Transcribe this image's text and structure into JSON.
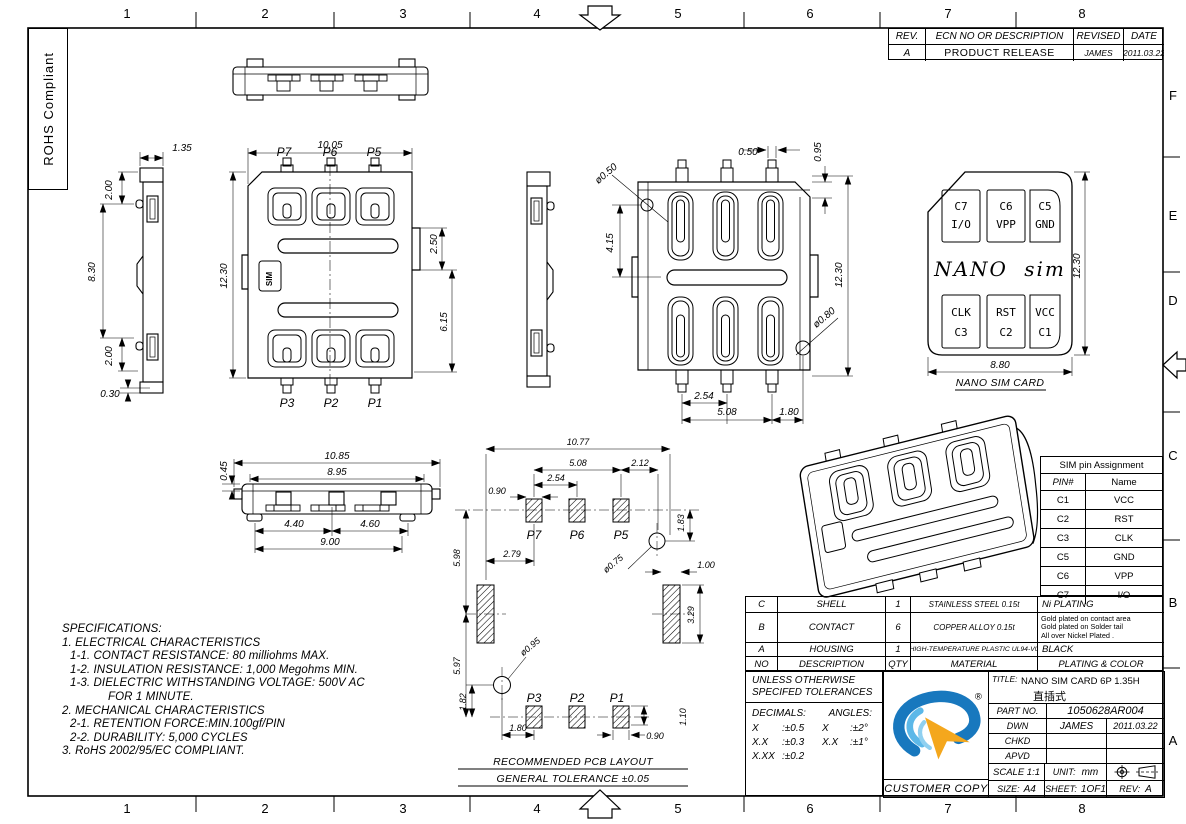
{
  "sheet": {
    "rohs": "ROHS Compliant",
    "zones_top": [
      "1",
      "2",
      "3",
      "4",
      "5",
      "6",
      "7",
      "8"
    ],
    "zones_bottom": [
      "1",
      "2",
      "3",
      "4",
      "5",
      "6",
      "7",
      "8"
    ],
    "zone_letters": [
      "F",
      "E",
      "D",
      "C",
      "B",
      "A"
    ]
  },
  "revision_table": {
    "rev_h": "REV.",
    "desc_h": "ECN NO OR DESCRIPTION",
    "revised_h": "REVISED",
    "date_h": "DATE",
    "rows": [
      {
        "rev": "A",
        "desc": "PRODUCT RELEASE",
        "revised": "JAMES",
        "date": "2011.03.22"
      }
    ]
  },
  "views": {
    "side_left": {
      "d_135": "1.35",
      "d_200_top": "2.00",
      "d_830": "8.30",
      "d_200_bot": "2.00",
      "d_030": "0.30"
    },
    "top_view": {
      "d_1005": "10.05",
      "d_1230": "12.30",
      "d_250": "2.50",
      "d_615": "6.15",
      "sim": "SIM",
      "p7": "P7",
      "p6": "P6",
      "p5": "P5",
      "p3": "P3",
      "p2": "P2",
      "p1": "P1"
    },
    "back_view": {
      "dia_050": "ø0.50",
      "d_050": "0.50",
      "d_095": "0.95",
      "d_415": "4.15",
      "d_1230": "12.30",
      "dia_080": "ø0.80",
      "d_254": "2.54",
      "d_508": "5.08",
      "d_180": "1.80"
    },
    "nano_card": {
      "brand": "NANO sim",
      "caption": "NANO SIM CARD",
      "d_1230": "12.30",
      "d_880": "8.80",
      "c7": "C7",
      "c7n": "I/O",
      "c6": "C6",
      "c6n": "VPP",
      "c5": "C5",
      "c5n": "GND",
      "c3n": "CLK",
      "c3": "C3",
      "c2n": "RST",
      "c2": "C2",
      "c1n": "VCC",
      "c1": "C1"
    },
    "front_view": {
      "d_1085": "10.85",
      "d_895": "8.95",
      "d_045": "0.45",
      "d_440": "4.40",
      "d_460": "4.60",
      "d_900": "9.00"
    },
    "pcb": {
      "d_1077": "10.77",
      "d_508": "5.08",
      "d_212": "2.12",
      "d_254": "2.54",
      "d_090a": "0.90",
      "d_279": "2.79",
      "d_598": "5.98",
      "d_597": "5.97",
      "dia_075": "ø0.75",
      "d_183": "1.83",
      "d_100": "1.00",
      "d_329": "3.29",
      "dia_095": "ø0.95",
      "d_182": "1.82",
      "d_180": "1.80",
      "d_110": "1.10",
      "d_090b": "0.90",
      "p7": "P7",
      "p6": "P6",
      "p5": "P5",
      "p3": "P3",
      "p2": "P2",
      "p1": "P1",
      "caption1": "RECOMMENDED PCB LAYOUT",
      "caption2": "GENERAL TOLERANCE ±0.05"
    }
  },
  "specs": {
    "title": "SPECIFICATIONS:",
    "lines": [
      "1. ELECTRICAL CHARACTERISTICS",
      "1-1. CONTACT RESISTANCE: 80 milliohms  MAX.",
      "1-2. INSULATION RESISTANCE: 1,000 Megohms MIN.",
      "1-3. DIELECTRIC WITHSTANDING VOLTAGE: 500V AC",
      "FOR 1 MINUTE.",
      "2. MECHANICAL CHARACTERISTICS",
      "2-1. RETENTION FORCE:MIN.100gf/PIN",
      "2-2. DURABILITY: 5,000 CYCLES",
      "3. RoHS 2002/95/EC COMPLIANT."
    ]
  },
  "pin_table": {
    "title": "SIM pin Assignment",
    "pin_h": "PIN#",
    "name_h": "Name",
    "rows": [
      [
        "C1",
        "VCC"
      ],
      [
        "C2",
        "RST"
      ],
      [
        "C3",
        "CLK"
      ],
      [
        "C5",
        "GND"
      ],
      [
        "C6",
        "VPP"
      ],
      [
        "C7",
        "I/O"
      ]
    ]
  },
  "bom": {
    "no_h": "NO",
    "desc_h": "DESCRIPTION",
    "qty_h": "QTY",
    "material_h": "MATERIAL",
    "plating_h": "PLATING & COLOR",
    "rows": [
      {
        "no": "C",
        "desc": "SHELL",
        "qty": "1",
        "material": "STAINLESS STEEL 0.15t",
        "plating1": "Ni PLATING",
        "plating2": "",
        "plating3": ""
      },
      {
        "no": "B",
        "desc": "CONTACT",
        "qty": "6",
        "material": "COPPER ALLOY 0.15t",
        "plating1": "Gold plated on contact area",
        "plating2": "Gold plated on Solder tail",
        "plating3": "All over Nickel Plated ."
      },
      {
        "no": "A",
        "desc": "HOUSING",
        "qty": "1",
        "material": "HIGH-TEMPERATURE PLASTIC UL94-V0",
        "plating1": "BLACK",
        "plating2": "",
        "plating3": ""
      }
    ]
  },
  "tolerances": {
    "line1": "UNLESS OTHERWISE",
    "line2": "SPECIFED TOLERANCES",
    "decimals_h": "DECIMALS:",
    "angles_h": "ANGLES:",
    "r1c1": "X",
    "r1c2": ":±0.5",
    "r1c3": "X",
    "r1c4": ":±2°",
    "r2c1": "X.X",
    "r2c2": ":±0.3",
    "r2c3": "X.X",
    "r2c4": ":±1°",
    "r3c1": "X.XX",
    "r3c2": ":±0.2"
  },
  "title_block": {
    "title_h": "TITLE:",
    "title1": "NANO SIM CARD 6P 1.35H",
    "title2": "直插式",
    "part_h": "PART NO.",
    "part_no": "1050628AR004",
    "dwn_h": "DWN",
    "dwn": "JAMES",
    "dwn_date": "2011.03.22",
    "chkd_h": "CHKD",
    "apvd_h": "APVD",
    "scale": "SCALE 1:1",
    "unit_h": "UNIT:",
    "unit": "mm",
    "customer": "CUSTOMER COPY",
    "size_h": "SIZE:",
    "size": "A4",
    "sheet_h": "SHEET:",
    "sheet": "1OF1",
    "rev_h": "REV:",
    "rev": "A",
    "registered": "®"
  },
  "colors": {
    "logo_blue": "#1878be",
    "logo_blue_light": "#5cb8e8",
    "logo_blue_pale": "#90d0f0",
    "logo_orange": "#f4a71d",
    "ink": "#000000",
    "paper": "#ffffff"
  }
}
